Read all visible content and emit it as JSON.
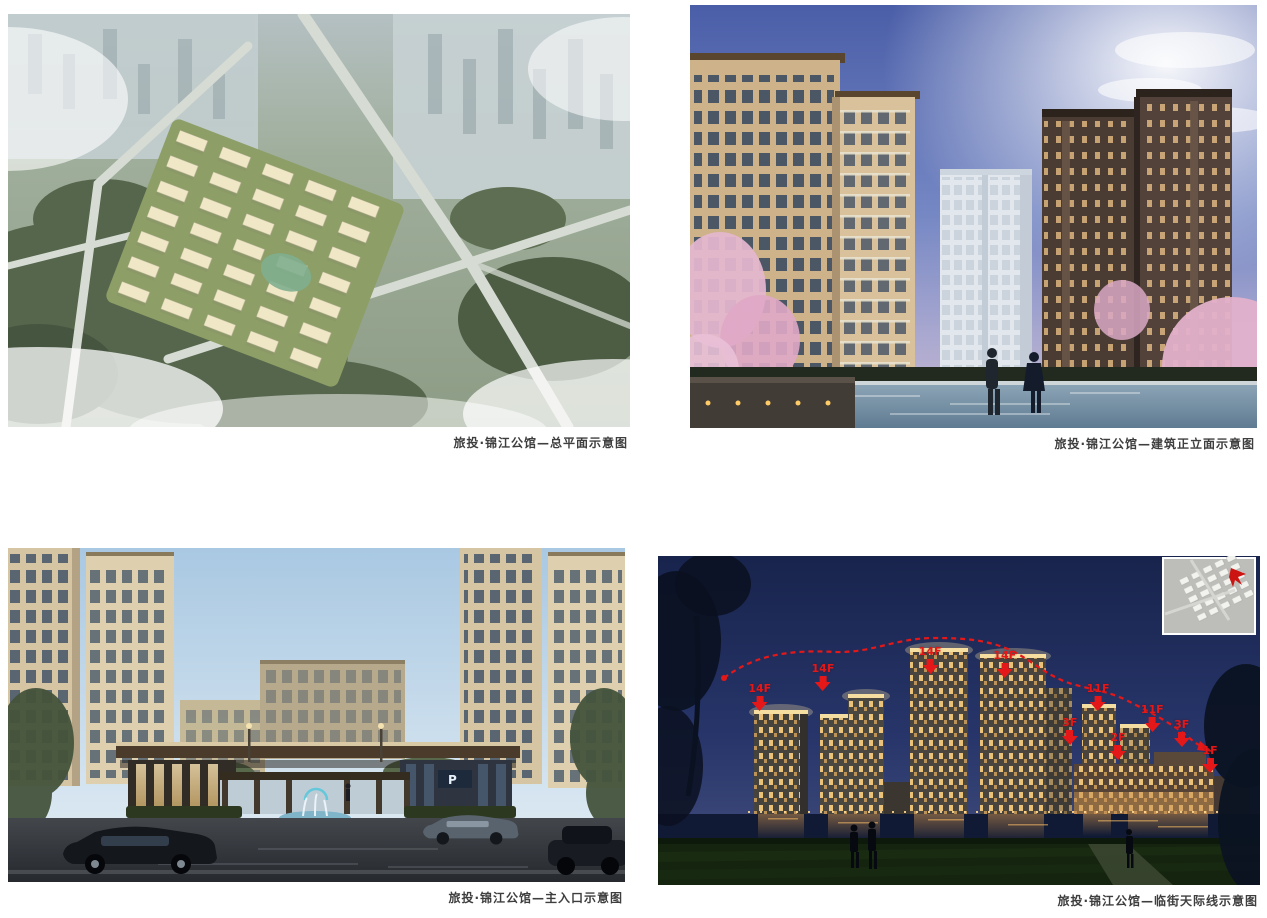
{
  "page": {
    "background": "#ffffff"
  },
  "figures": [
    {
      "id": "site-plan",
      "caption": "旅投·锦江公馆—总平面示意图"
    },
    {
      "id": "building-elevation",
      "caption": "旅投·锦江公馆—建筑正立面示意图"
    },
    {
      "id": "main-entrance",
      "caption": "旅投·锦江公馆—主入口示意图"
    },
    {
      "id": "street-skyline",
      "caption": "旅投·锦江公馆—临街天际线示意图"
    }
  ],
  "entrance": {
    "parking_sign": "P"
  },
  "skyline": {
    "annotation_color": "#e41818",
    "floor_labels": [
      {
        "text": "14F",
        "x": 16.9,
        "y": 38.5
      },
      {
        "text": "14F",
        "x": 27.4,
        "y": 32.5
      },
      {
        "text": "14F",
        "x": 45.2,
        "y": 27.5
      },
      {
        "text": "14F",
        "x": 57.6,
        "y": 28.5
      },
      {
        "text": "11F",
        "x": 73.1,
        "y": 38.5
      },
      {
        "text": "3F",
        "x": 68.4,
        "y": 49.0
      },
      {
        "text": "2F",
        "x": 76.4,
        "y": 53.5
      },
      {
        "text": "11F",
        "x": 82.1,
        "y": 45.0
      },
      {
        "text": "3F",
        "x": 87.0,
        "y": 49.5
      },
      {
        "text": "1F",
        "x": 91.7,
        "y": 57.5
      }
    ]
  }
}
